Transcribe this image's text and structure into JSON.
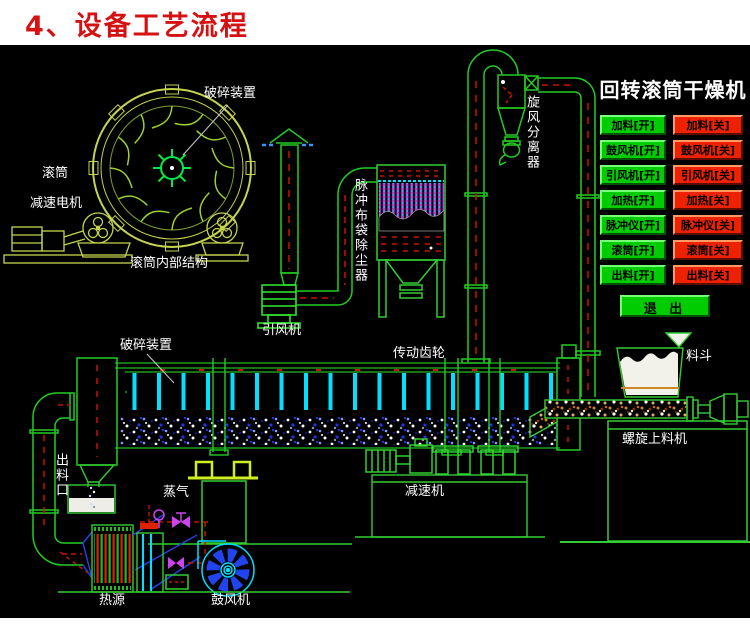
{
  "header": {
    "title": "4、设备工艺流程"
  },
  "panel": {
    "title": "回转滚筒干燥机",
    "rows": [
      {
        "on": "加料[开]",
        "off": "加料[关]"
      },
      {
        "on": "鼓风机[开]",
        "off": "鼓风机[关]"
      },
      {
        "on": "引风机[开]",
        "off": "引风机[关]"
      },
      {
        "on": "加热[开]",
        "off": "加热[关]"
      },
      {
        "on": "脉冲仪[开]",
        "off": "脉冲仪[关]"
      },
      {
        "on": "滚筒[开]",
        "off": "滚筒[关]"
      },
      {
        "on": "出料[开]",
        "off": "出料[关]"
      }
    ],
    "exit": "退 出",
    "colors": {
      "on_bg": "#00cc00",
      "off_bg": "#ee2200",
      "text": "#000000",
      "title": "#ffffff"
    }
  },
  "diagram": {
    "labels": {
      "crusher_top": "破碎装置",
      "drum": "滚筒",
      "gear_motor": "减速电机",
      "drum_internal": "滚筒内部结构",
      "bag_filter": "脉冲布袋除尘器",
      "cyclone": "旋风分离器",
      "induced_fan": "引风机",
      "crusher_drum": "破碎装置",
      "drive_gear": "传动齿轮",
      "hopper": "料斗",
      "screw_feeder": "螺旋上料机",
      "discharge_port": "出料口",
      "steam": "蒸气",
      "reducer": "减速机",
      "heat_source": "热源",
      "blower": "鼓风机"
    },
    "colors": {
      "pipe_green": "#22cc22",
      "machine_yellow": "#c6d34f",
      "cyan": "#00e0ff",
      "magenta": "#cc44ee",
      "flow_red": "#cc1100",
      "blue": "#2244ee",
      "label_white": "#ffffff"
    }
  }
}
